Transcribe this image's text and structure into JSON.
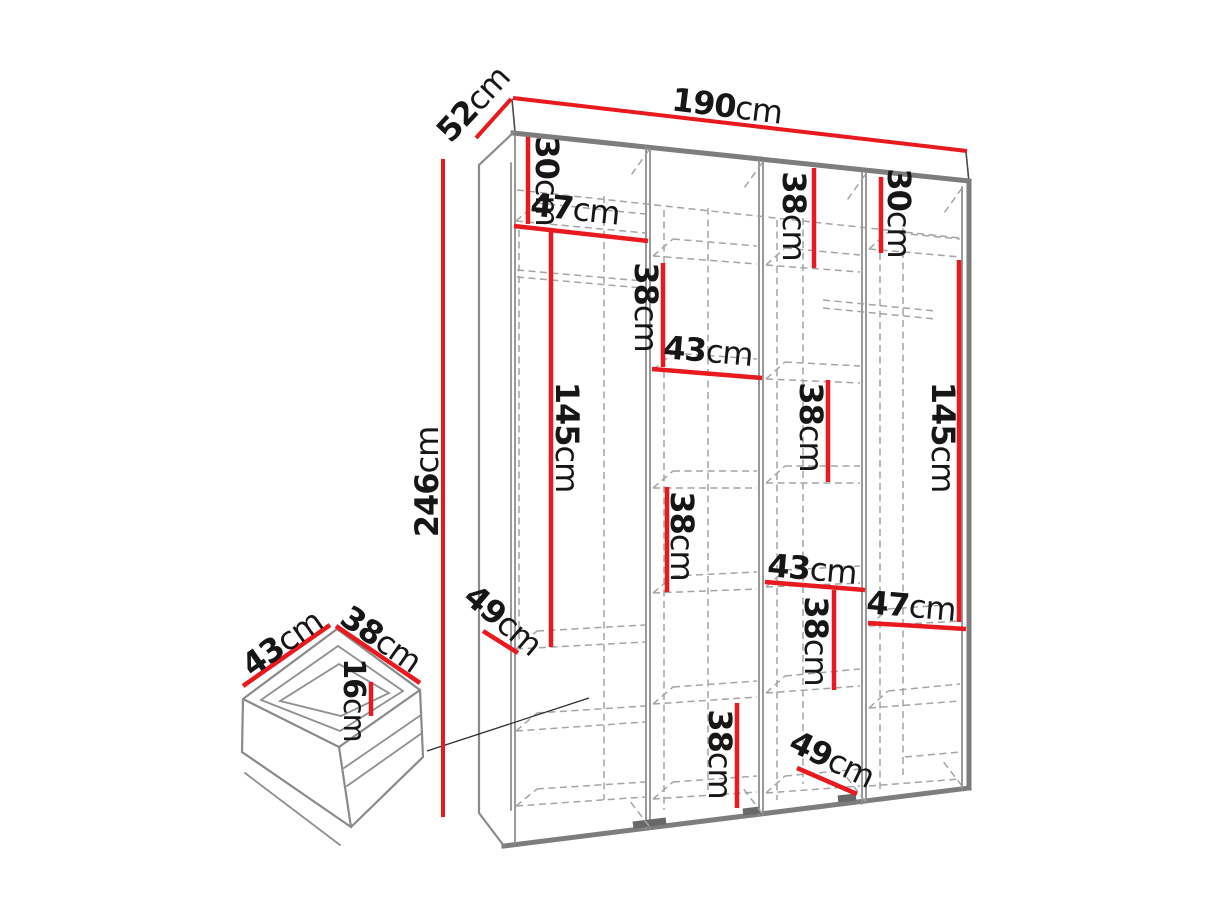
{
  "palette": {
    "red": "#e8191f",
    "line_gray": "#8a8a8a",
    "text_black": "#161616",
    "background": "#ffffff"
  },
  "wardrobe": {
    "width": {
      "value": "190",
      "unit": "cm"
    },
    "depth": {
      "value": "52",
      "unit": "cm"
    },
    "height": {
      "value": "246",
      "unit": "cm"
    },
    "sections": {
      "col1_top_height": {
        "value": "30",
        "unit": "cm"
      },
      "col1_width": {
        "value": "47",
        "unit": "cm"
      },
      "col1_hanging_height": {
        "value": "145",
        "unit": "cm"
      },
      "col1_shelf_depth": {
        "value": "49",
        "unit": "cm"
      },
      "col2_upper_section": {
        "value": "38",
        "unit": "cm"
      },
      "col2_width": {
        "value": "43",
        "unit": "cm"
      },
      "col2_middle_section": {
        "value": "38",
        "unit": "cm"
      },
      "col2_bottom_section": {
        "value": "38",
        "unit": "cm"
      },
      "col3_top_section": {
        "value": "38",
        "unit": "cm"
      },
      "col3_upper_section": {
        "value": "38",
        "unit": "cm"
      },
      "col3_width": {
        "value": "43",
        "unit": "cm"
      },
      "col3_lower_section": {
        "value": "38",
        "unit": "cm"
      },
      "col3_floor_depth": {
        "value": "49",
        "unit": "cm"
      },
      "col4_top_height": {
        "value": "30",
        "unit": "cm"
      },
      "col4_hanging_height": {
        "value": "145",
        "unit": "cm"
      },
      "col4_width": {
        "value": "47",
        "unit": "cm"
      }
    }
  },
  "drawer": {
    "width": {
      "value": "43",
      "unit": "cm"
    },
    "depth": {
      "value": "38",
      "unit": "cm"
    },
    "inner_height": {
      "value": "16",
      "unit": "cm"
    }
  }
}
